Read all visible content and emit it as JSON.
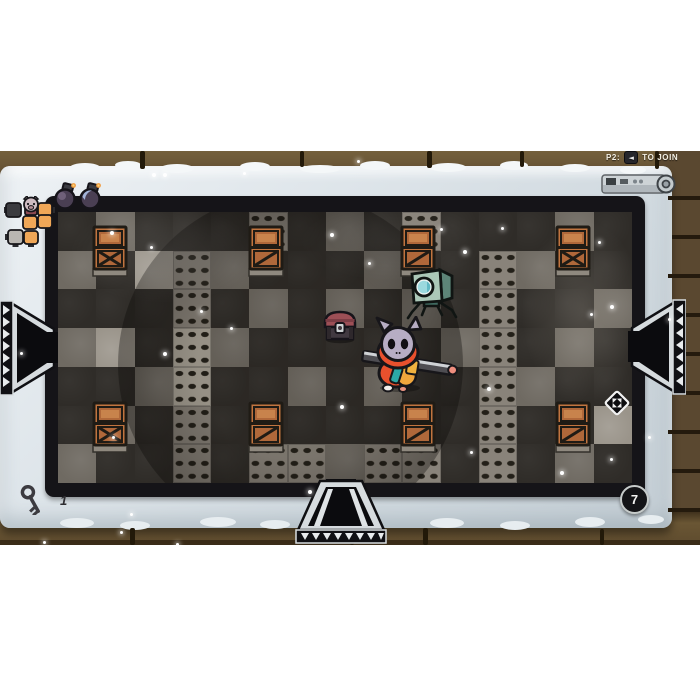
{
  "hud": {
    "join_prompt": {
      "player_label": "P2:",
      "button_glyph": "◄",
      "action_label": "TO JOIN"
    },
    "key_counter": {
      "icon": "key-icon",
      "count": "1"
    },
    "room_badge": {
      "value": "7"
    },
    "bomb_slots": [
      {
        "icon": "bomb-icon",
        "variant": "purple"
      },
      {
        "icon": "bomb-icon",
        "variant": "blue"
      }
    ],
    "minimap": {
      "player_marker": "pig-face-icon",
      "rooms": [
        {
          "x": 2,
          "y": 7,
          "w": 15,
          "h": 14,
          "type": "dark",
          "nub": "left"
        },
        {
          "x": 34,
          "y": 7,
          "w": 14,
          "h": 13,
          "type": "orange",
          "nub": "right"
        },
        {
          "x": 19,
          "y": 20,
          "w": 14,
          "h": 13,
          "type": "orange",
          "nub": "none"
        },
        {
          "x": 34,
          "y": 19,
          "w": 14,
          "h": 13,
          "type": "orange",
          "nub": "none"
        },
        {
          "x": 4,
          "y": 34,
          "w": 15,
          "h": 14,
          "type": "gray",
          "nub": "left-bottom"
        },
        {
          "x": 20,
          "y": 35,
          "w": 14,
          "h": 13,
          "type": "orange",
          "nub": "bottom"
        }
      ]
    }
  },
  "arena": {
    "tile_legend": {
      "d": "dark",
      "g": "gray",
      "l": "light",
      "o": "oval-studs",
      "O": "oval-studs-light"
    },
    "tile_map": [
      "dgdddodgdodddgd",
      "gdlogdddgddogdd",
      "dddodgdgdgdoddg",
      "gldOgdddddgodgd",
      "ddgOddgdgddogdd",
      "dgdodddddddoddl",
      "gddodoogoododgd"
    ],
    "crates": [
      {
        "x": 92,
        "y": 225,
        "style": "cross"
      },
      {
        "x": 248,
        "y": 225,
        "style": "slash"
      },
      {
        "x": 400,
        "y": 225,
        "style": "slash"
      },
      {
        "x": 555,
        "y": 225,
        "style": "cross"
      },
      {
        "x": 92,
        "y": 401,
        "style": "cross"
      },
      {
        "x": 248,
        "y": 401,
        "style": "slash"
      },
      {
        "x": 400,
        "y": 401,
        "style": "slash"
      },
      {
        "x": 555,
        "y": 401,
        "style": "slash"
      }
    ],
    "chest": {
      "x": 321,
      "y": 308,
      "icon": "chest-icon"
    },
    "robot": {
      "x": 406,
      "y": 262,
      "icon": "robot-enemy"
    },
    "player": {
      "x": 358,
      "y": 316,
      "character": "hooded-cat-with-sword"
    },
    "pickup": {
      "x": 604,
      "y": 390,
      "icon": "diamond-pickup-icon"
    },
    "doors": [
      {
        "side": "left"
      },
      {
        "side": "right"
      },
      {
        "side": "bottom"
      }
    ],
    "sparkles": [
      [
        152,
        173,
        4
      ],
      [
        163,
        173,
        4
      ],
      [
        243,
        172,
        3
      ],
      [
        357,
        160,
        3
      ],
      [
        110,
        231,
        4
      ],
      [
        150,
        246,
        3
      ],
      [
        330,
        233,
        4
      ],
      [
        368,
        262,
        3
      ],
      [
        440,
        228,
        3
      ],
      [
        463,
        250,
        4
      ],
      [
        501,
        227,
        3
      ],
      [
        598,
        241,
        3
      ],
      [
        200,
        310,
        3
      ],
      [
        230,
        327,
        3
      ],
      [
        163,
        352,
        4
      ],
      [
        610,
        305,
        4
      ],
      [
        590,
        313,
        3
      ],
      [
        668,
        318,
        3
      ],
      [
        20,
        352,
        3
      ],
      [
        487,
        387,
        4
      ],
      [
        340,
        405,
        4
      ],
      [
        112,
        436,
        3
      ],
      [
        648,
        436,
        3
      ],
      [
        470,
        451,
        3
      ],
      [
        560,
        471,
        4
      ],
      [
        610,
        458,
        3
      ],
      [
        308,
        490,
        4
      ],
      [
        130,
        513,
        3
      ],
      [
        43,
        541,
        3
      ],
      [
        120,
        531,
        3
      ],
      [
        176,
        543,
        3
      ]
    ],
    "decor": {
      "frame_bumps_top": [
        [
          70,
          163,
          30,
          9
        ],
        [
          115,
          161,
          26,
          8
        ],
        [
          160,
          164,
          34,
          9
        ],
        [
          240,
          162,
          30,
          9
        ],
        [
          300,
          165,
          40,
          8
        ],
        [
          360,
          161,
          30,
          9
        ],
        [
          430,
          163,
          36,
          9
        ],
        [
          500,
          161,
          28,
          9
        ],
        [
          560,
          164,
          30,
          8
        ],
        [
          620,
          166,
          26,
          8
        ]
      ],
      "frame_bumps_bottom": [
        [
          60,
          518,
          34,
          10
        ],
        [
          120,
          521,
          30,
          9
        ],
        [
          200,
          517,
          36,
          10
        ],
        [
          260,
          520,
          30,
          9
        ],
        [
          430,
          518,
          34,
          10
        ],
        [
          500,
          521,
          30,
          9
        ],
        [
          575,
          517,
          30,
          10
        ],
        [
          638,
          515,
          26,
          9
        ]
      ],
      "brick_joints": [
        [
          140,
          151,
          5,
          18
        ],
        [
          300,
          151,
          4,
          16
        ],
        [
          427,
          151,
          5,
          17
        ],
        [
          520,
          151,
          4,
          16
        ],
        [
          655,
          151,
          4,
          18
        ],
        [
          130,
          528,
          5,
          17
        ],
        [
          350,
          529,
          4,
          16
        ],
        [
          423,
          528,
          5,
          17
        ],
        [
          600,
          529,
          4,
          16
        ]
      ],
      "brick_seams_right": [
        [
          668,
          196,
          32,
          4
        ],
        [
          672,
          235,
          28,
          4
        ],
        [
          668,
          274,
          32,
          4
        ],
        [
          672,
          313,
          28,
          4
        ],
        [
          668,
          352,
          32,
          4
        ],
        [
          672,
          391,
          28,
          4
        ],
        [
          668,
          430,
          32,
          4
        ],
        [
          672,
          469,
          28,
          4
        ],
        [
          668,
          508,
          32,
          4
        ]
      ]
    }
  },
  "colors": {
    "page_bg": "#ffffff",
    "brick": "#5f4c31",
    "brick_seam": "#221909",
    "stone_frame": "#dee5ea",
    "arena_border": "#151418",
    "tile_dark": "#2f2c28",
    "tile_gray": "#6f6a62",
    "tile_light": "#9a948a",
    "crate_orange": "#c1743f",
    "chest_maroon": "#9d4f56",
    "robot_teal": "#abc8b8",
    "robot_eye_cyan": "#9bd9de",
    "cat_head": "#b7adc4",
    "cat_hood_red": "#e8502d",
    "cat_vest_orange": "#f0a63c",
    "accent_teal": "#2ba7a5",
    "minimap_orange": "#f0a757",
    "text_light": "#f3efe4"
  }
}
